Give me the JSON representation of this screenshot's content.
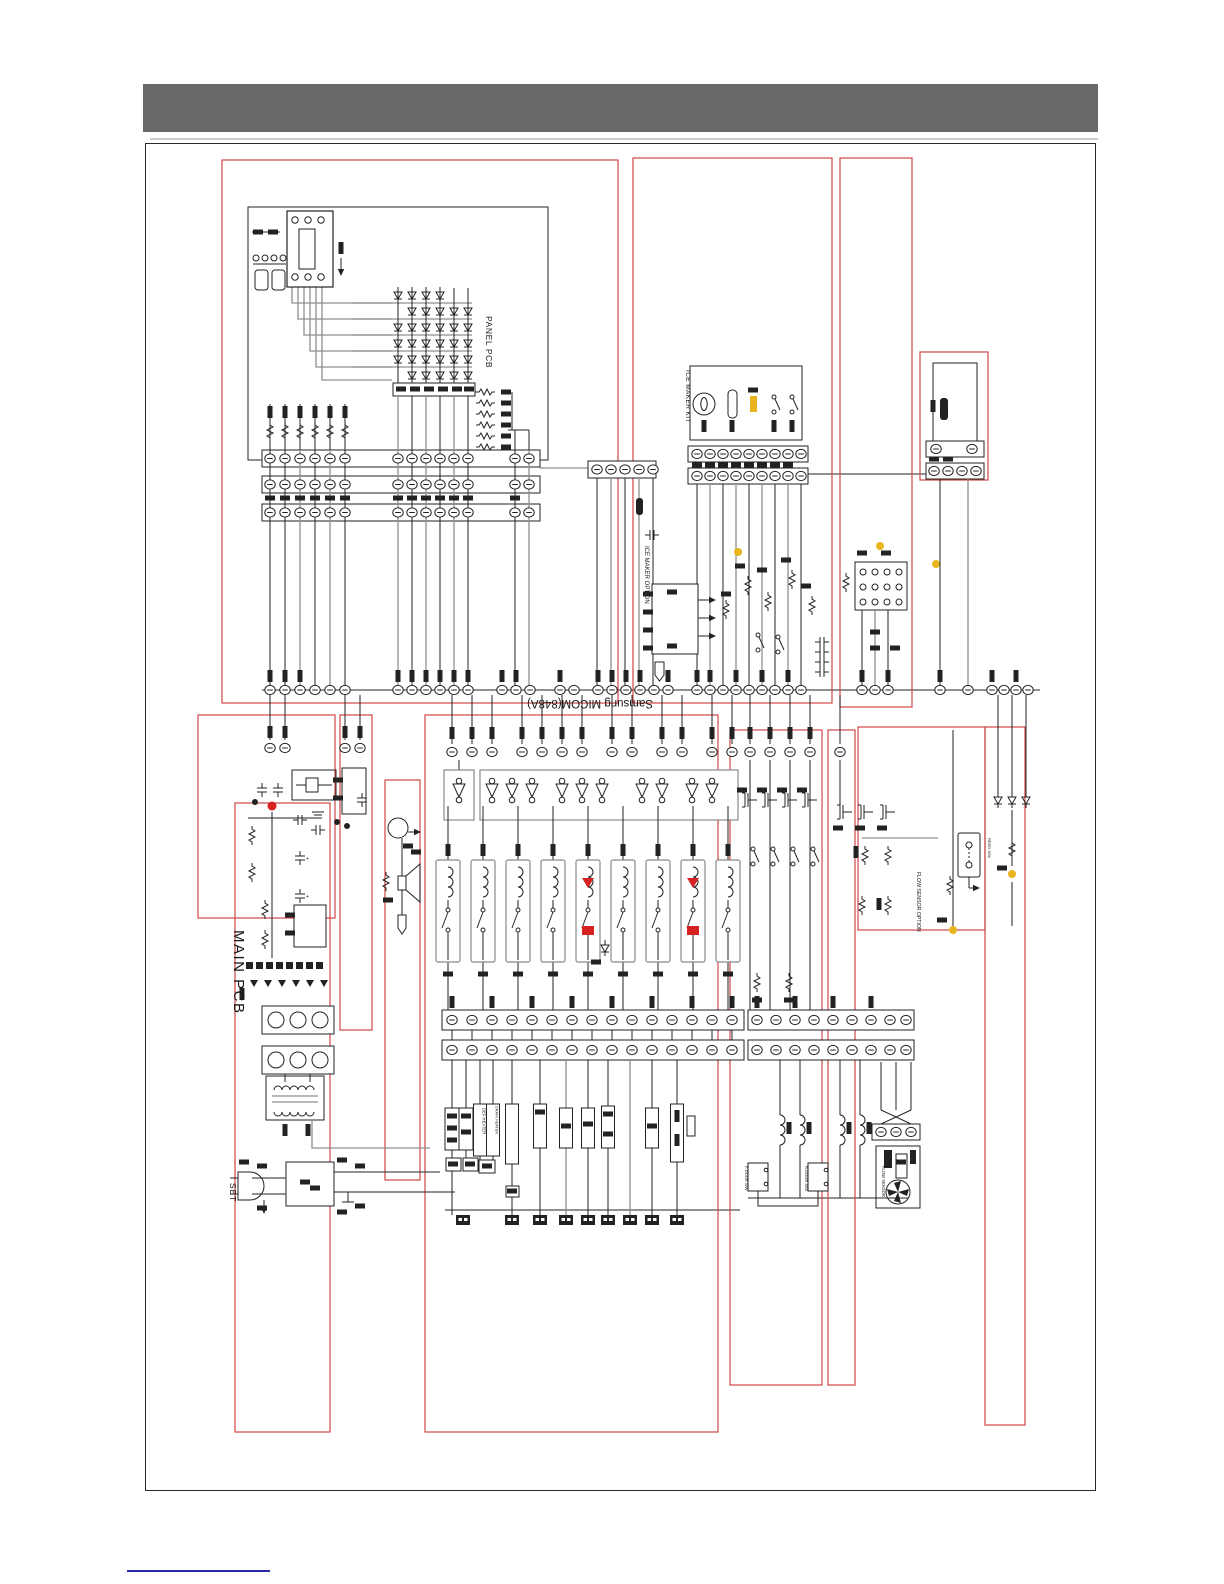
{
  "labels": {
    "panel_pcb": "PANEL PCB",
    "ice_maker_kit": "ICE MAKER KIT",
    "ice_maker_option": "ICE MAKER OPTION",
    "micom": "Samsung  MICOM(848A)",
    "main_pcb": "MAIN PCB",
    "set_label": "SET",
    "flow_sensor_option": "FLOW SENSOR OPTION",
    "flow_sensor": "FLOW SENSOR",
    "f_door_sw": "F-DOOR S/W",
    "r_door_sw": "R-DOOR S/W",
    "def_heater": "DEF HEATER",
    "drain_heater": "DRAIN HEATER",
    "reed_sw": "REED S/W"
  },
  "colors": {
    "header_gray": "#696969",
    "divider_gray": "#cccccc",
    "red_outline": "#cf4545",
    "accent_red": "#d42222",
    "highlight_yellow": "#e9b51f",
    "link_blue": "#2b2ba6",
    "wire_gray": "#8f8f8f",
    "wire_black": "#232323"
  }
}
